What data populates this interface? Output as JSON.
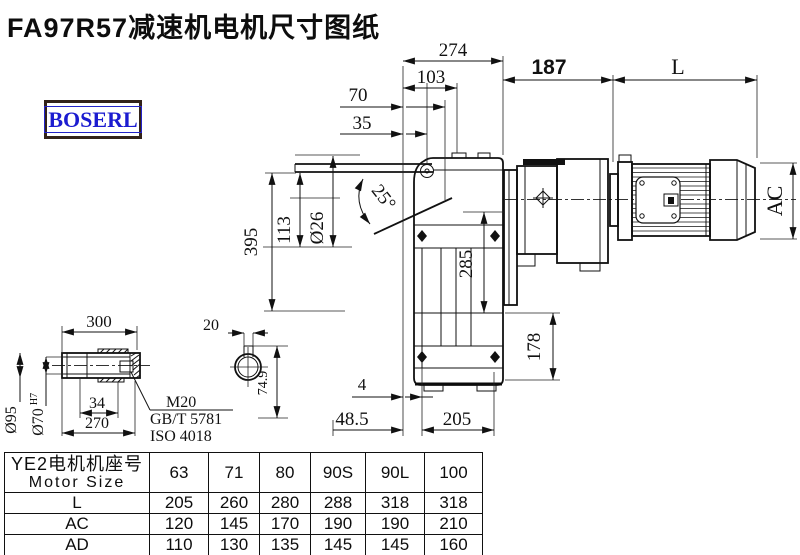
{
  "title": "FA97R57减速机电机尺寸图纸",
  "logo": "BOSERL",
  "dims": {
    "d274": "274",
    "d103": "103",
    "d70": "70",
    "d35": "35",
    "d187": "187",
    "dL": "L",
    "dAC": "AC",
    "d395": "395",
    "d113": "113",
    "dphi26": "Ø26",
    "d25": "25°",
    "d285": "285",
    "d178": "178",
    "d4": "4",
    "d48_5": "48.5",
    "d205": "205",
    "d300": "300",
    "d20": "20",
    "d34": "34",
    "d270": "270",
    "d74_9": "74.9",
    "dphi95": "Ø95",
    "dphi70": "Ø70",
    "dphi70sup": "H7",
    "m20": "M20",
    "gbt": "GB/T 5781",
    "iso": "ISO 4018"
  },
  "table": {
    "header_cn": "YE2电机机座号",
    "header_en": "Motor Size",
    "columns": [
      "63",
      "71",
      "80",
      "90S",
      "90L",
      "100"
    ],
    "rows": [
      {
        "label": "L",
        "values": [
          "205",
          "260",
          "280",
          "288",
          "318",
          "318"
        ]
      },
      {
        "label": "AC",
        "values": [
          "120",
          "145",
          "170",
          "190",
          "190",
          "210"
        ]
      },
      {
        "label": "AD",
        "values": [
          "110",
          "130",
          "135",
          "145",
          "145",
          "160"
        ]
      }
    ]
  }
}
